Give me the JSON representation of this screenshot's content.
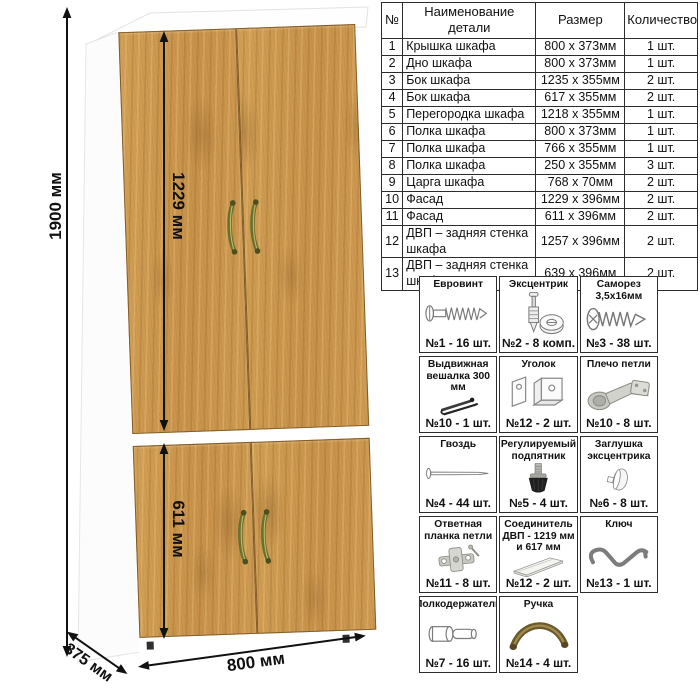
{
  "dimensions": {
    "height": "1900 мм",
    "upper_facade_height": "1229 мм",
    "lower_facade_height": "611 мм",
    "width": "800 мм",
    "depth": "375 мм"
  },
  "parts_table": {
    "headers": [
      "№",
      "Наименование детали",
      "Размер",
      "Количество"
    ],
    "rows": [
      {
        "num": "1",
        "name": "Крышка шкафа",
        "size": "800 x 373мм",
        "qty": "1 шт."
      },
      {
        "num": "2",
        "name": "Дно шкафа",
        "size": "800 x 373мм",
        "qty": "1 шт."
      },
      {
        "num": "3",
        "name": "Бок шкафа",
        "size": "1235 x 355мм",
        "qty": "2 шт."
      },
      {
        "num": "4",
        "name": "Бок шкафа",
        "size": "617 x 355мм",
        "qty": "2 шт."
      },
      {
        "num": "5",
        "name": "Перегородка шкафа",
        "size": "1218 x 355мм",
        "qty": "1 шт."
      },
      {
        "num": "6",
        "name": "Полка шкафа",
        "size": "800 x 373мм",
        "qty": "1 шт."
      },
      {
        "num": "7",
        "name": "Полка шкафа",
        "size": "766 x 355мм",
        "qty": "1 шт."
      },
      {
        "num": "8",
        "name": "Полка шкафа",
        "size": "250 x 355мм",
        "qty": "3 шт."
      },
      {
        "num": "9",
        "name": "Царга шкафа",
        "size": "768 x 70мм",
        "qty": "2 шт."
      },
      {
        "num": "10",
        "name": "Фасад",
        "size": "1229 x 396мм",
        "qty": "2 шт."
      },
      {
        "num": "11",
        "name": "Фасад",
        "size": "611 x 396мм",
        "qty": "2 шт."
      },
      {
        "num": "12",
        "name": "ДВП – задняя стенка шкафа",
        "size": "1257 x 396мм",
        "qty": "2 шт."
      },
      {
        "num": "13",
        "name": "ДВП – задняя стенка шкафа",
        "size": "639 x 396мм",
        "qty": "2 шт."
      }
    ]
  },
  "hardware": {
    "items": [
      {
        "title": "Евровинт",
        "icon": "euro-screw-icon",
        "count": "№1 - 16 шт."
      },
      {
        "title": "Эксцентрик",
        "icon": "cam-bolt-icon",
        "count": "№2 - 8 комп."
      },
      {
        "title": "Саморез 3,5х16мм",
        "icon": "small-screw-icon",
        "count": "№3 - 38 шт."
      },
      {
        "title": "Выдвижная вешалка 300 мм",
        "icon": "pullout-hanger-icon",
        "count": "№10 - 1 шт."
      },
      {
        "title": "Уголок",
        "icon": "angle-bracket-icon",
        "count": "№12 - 2 шт."
      },
      {
        "title": "Плечо петли",
        "icon": "hinge-arm-icon",
        "count": "№10 - 8 шт."
      },
      {
        "title": "Гвоздь",
        "icon": "nail-icon",
        "count": "№4 - 44 шт."
      },
      {
        "title": "Регулируемый подпятник",
        "icon": "adjustable-foot-icon",
        "count": "№5 - 4 шт."
      },
      {
        "title": "Заглушка эксцентрика",
        "icon": "cam-cap-icon",
        "count": "№6 - 8 шт."
      },
      {
        "title": "Ответная планка петли",
        "icon": "hinge-plate-icon",
        "count": "№11 - 8 шт."
      },
      {
        "title": "Соединитель ДВП - 1219 мм и 617 мм",
        "icon": "hdf-connector-icon",
        "count": "№12 - 2 шт."
      },
      {
        "title": "Ключ",
        "icon": "allen-key-icon",
        "count": "№13 - 1 шт."
      },
      {
        "title": "Полкодержатель",
        "icon": "shelf-pin-icon",
        "count": "№7 - 16 шт."
      },
      {
        "title": "Ручка",
        "icon": "handle-icon",
        "count": "№14 - 4 шт."
      }
    ]
  },
  "colors": {
    "wood": "#cd9a52",
    "wood_edge": "#6e481a",
    "carcass": "#ffffff",
    "handle_bronze": "#6c6e2f",
    "line": "#111111",
    "table_border": "#2c2c2c"
  }
}
